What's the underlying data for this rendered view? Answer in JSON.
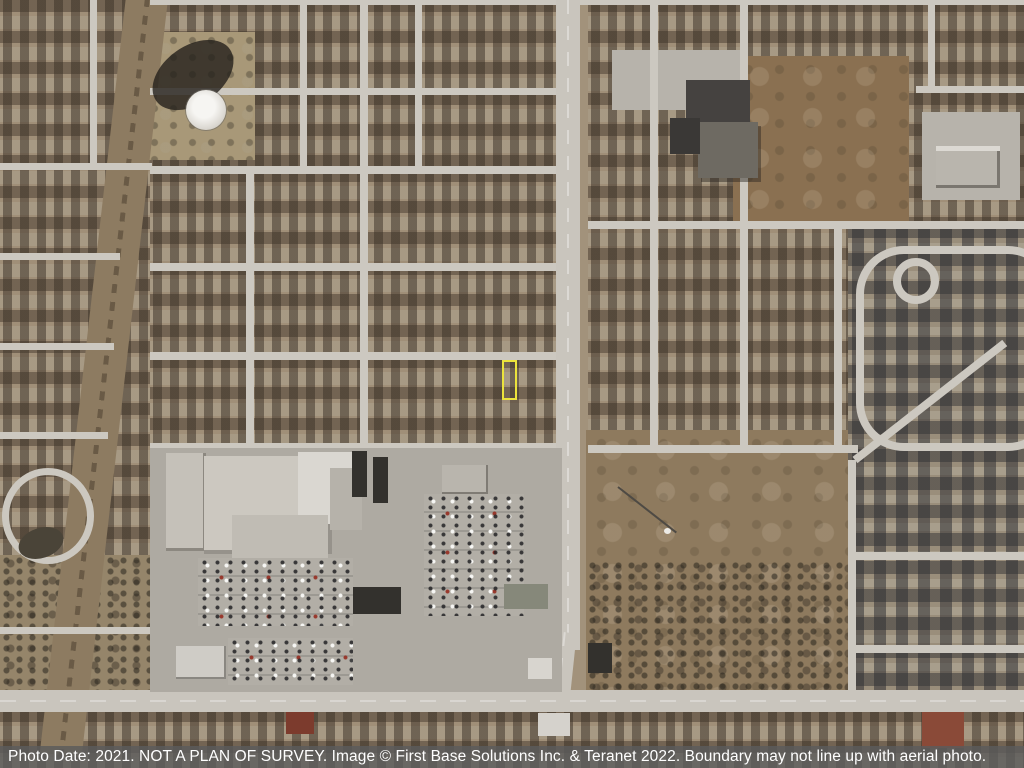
{
  "caption": {
    "full_text": "Photo Date: 2021. NOT A PLAN OF SURVEY. Image © First Base Solutions Inc. & Teranet 2022. Boundary may not line up with aerial photo.",
    "photo_date_label": "Photo Date:",
    "photo_date": "2021",
    "disclaimer": "NOT A PLAN OF SURVEY",
    "image_credit": "Image © First Base Solutions Inc. & Teranet 2022",
    "boundary_note": "Boundary may not line up with aerial photo."
  },
  "overlay": {
    "property_boundary_color": "#ece33c",
    "property_boundary_shape": "rectangle"
  },
  "colors": {
    "caption_bar_background": "#5c5c5c",
    "caption_text": "#ffffff",
    "ground_tone": "#a2927b",
    "road_tone": "#ccc8c0"
  }
}
